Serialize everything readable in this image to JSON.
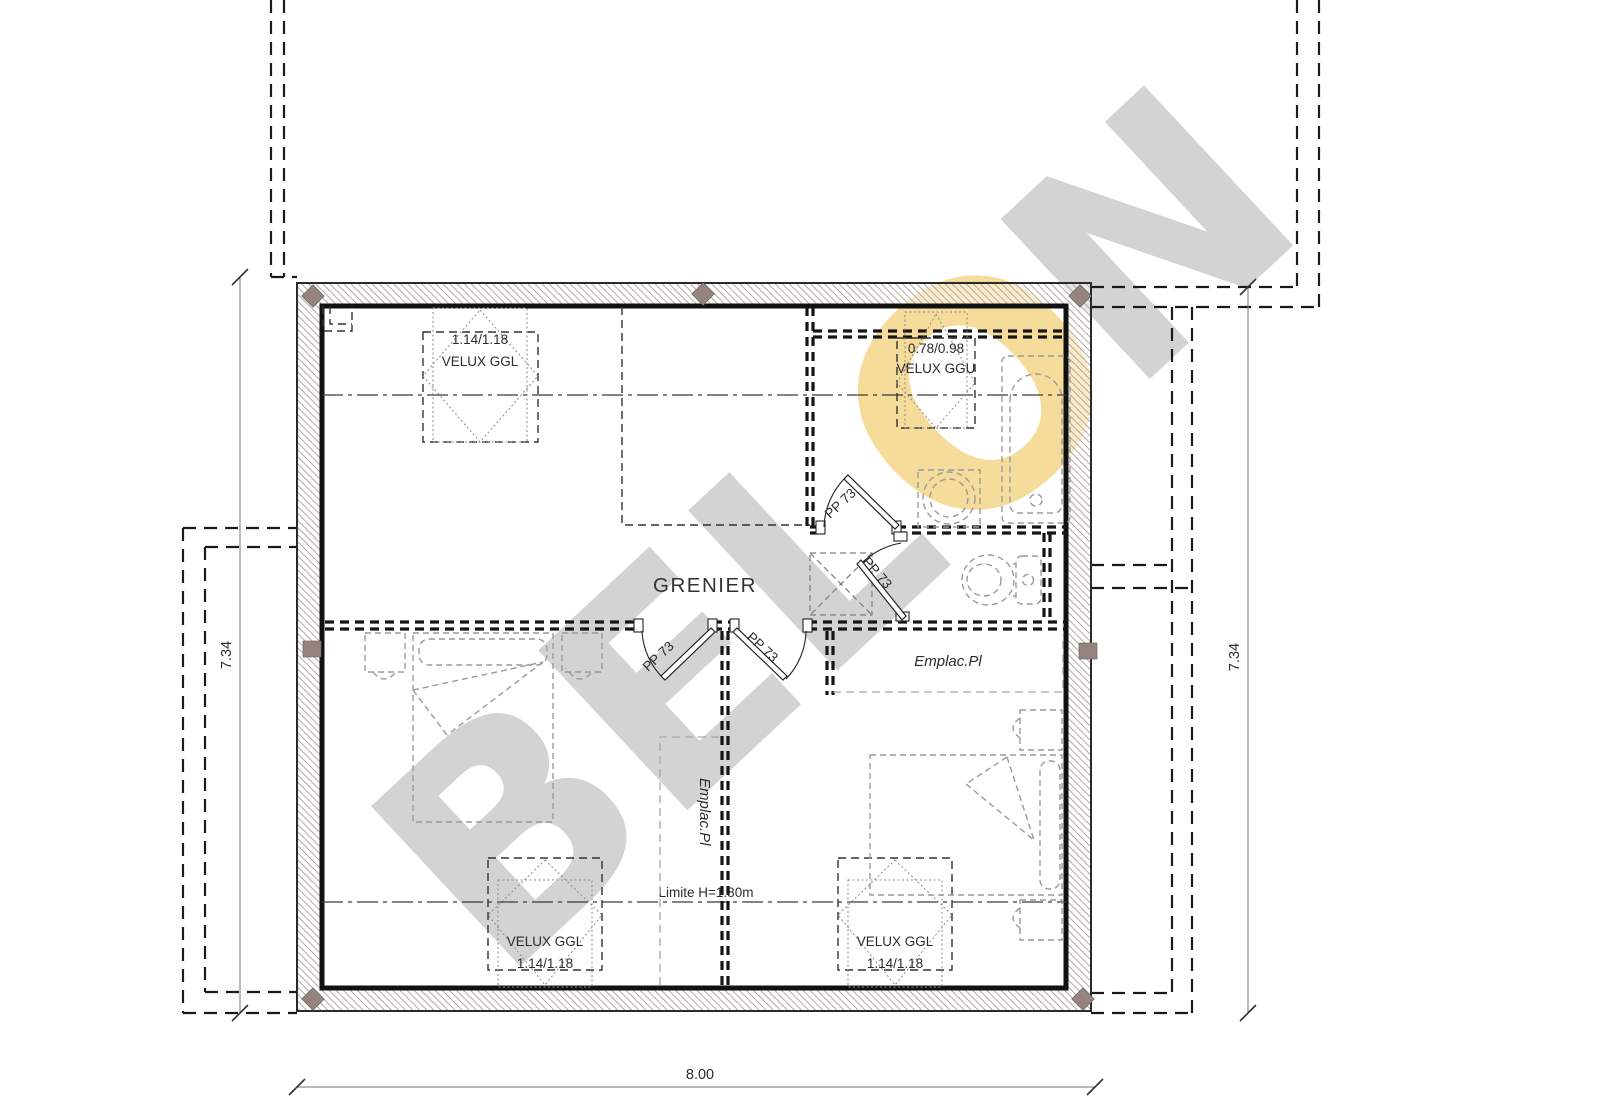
{
  "document": {
    "type": "floor-plan",
    "room_label": "GRENIER",
    "height_limit_label": "Limite H=1.80m"
  },
  "watermark": {
    "part1": "BEL",
    "part2": "O",
    "part3": "N",
    "gray_color": "#d3d3d3",
    "accent_color": "#f6dc9a"
  },
  "windows": {
    "top_left": {
      "line1": "1.14/1.18",
      "line2": "VELUX GGL"
    },
    "top_right": {
      "line1": "0.78/0.98",
      "line2": "VELUX GGU"
    },
    "bottom_left": {
      "line1": "VELUX GGL",
      "line2": "1.14/1.18"
    },
    "bottom_right": {
      "line1": "VELUX GGL",
      "line2": "1.14/1.18"
    }
  },
  "doors": {
    "label": "PP 73"
  },
  "closets": {
    "upper_label": "Emplac.Pl",
    "lower_label": "Emplac.Pl"
  },
  "dimensions": {
    "left": "7.34",
    "right": "7.34",
    "bottom": "8.00"
  }
}
